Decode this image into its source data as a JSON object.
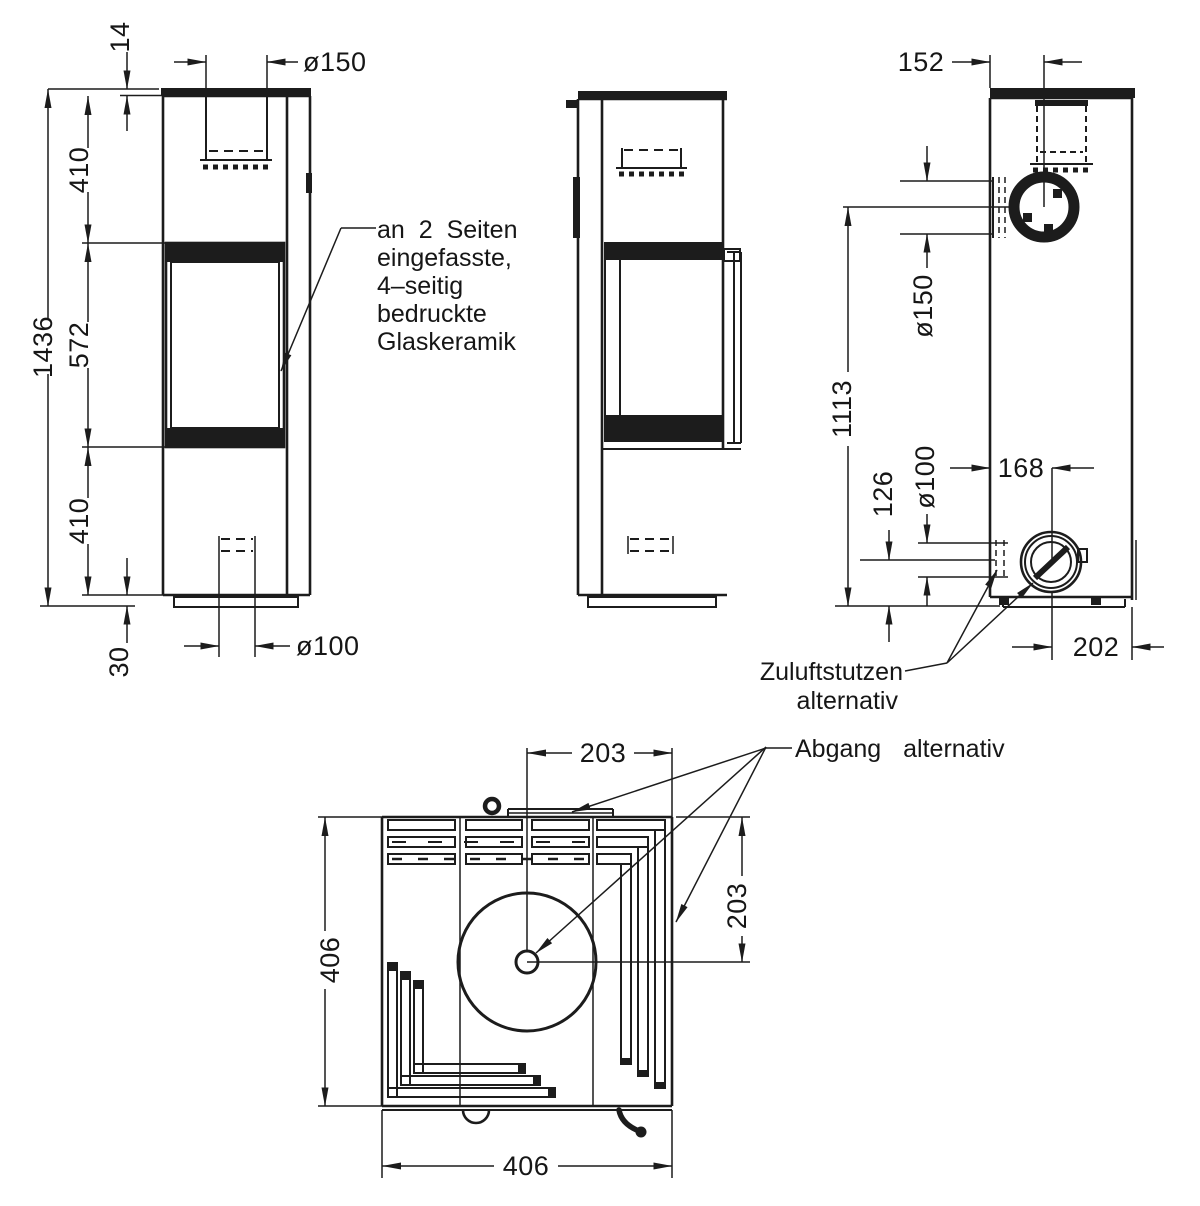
{
  "sheet": {
    "background": "#ffffff",
    "ink": "#1c1c1c"
  },
  "views": {
    "front": {
      "dims": {
        "top_plate": "14",
        "flue_diameter": "ø150",
        "upper_section": "410",
        "glass_height": "572",
        "lower_section": "410",
        "total_height": "1436",
        "plinth_height": "30",
        "air_inlet_diameter": "ø100"
      },
      "glass_note": {
        "line1": "an 2 Seiten",
        "line2": "eingefasste,",
        "line3": "4–seitig",
        "line4": "bedruckte",
        "line5": "Glaskeramik"
      }
    },
    "rear": {
      "dims": {
        "flue_offset_from_edge": "152",
        "flue_center_height": "1113",
        "side_flue_diameter": "ø150",
        "air_center_height": "126",
        "air_inlet_diameter": "ø100",
        "air_offset_left": "168",
        "air_offset_right": "202"
      },
      "labels": {
        "zuluft_line1": "Zuluftstutzen",
        "zuluft_line2": "alternativ",
        "abgang": "Abgang alternativ"
      }
    },
    "top": {
      "dims": {
        "flue_from_center_right": "203",
        "flue_from_rear": "203",
        "depth": "406",
        "width": "406"
      }
    }
  }
}
